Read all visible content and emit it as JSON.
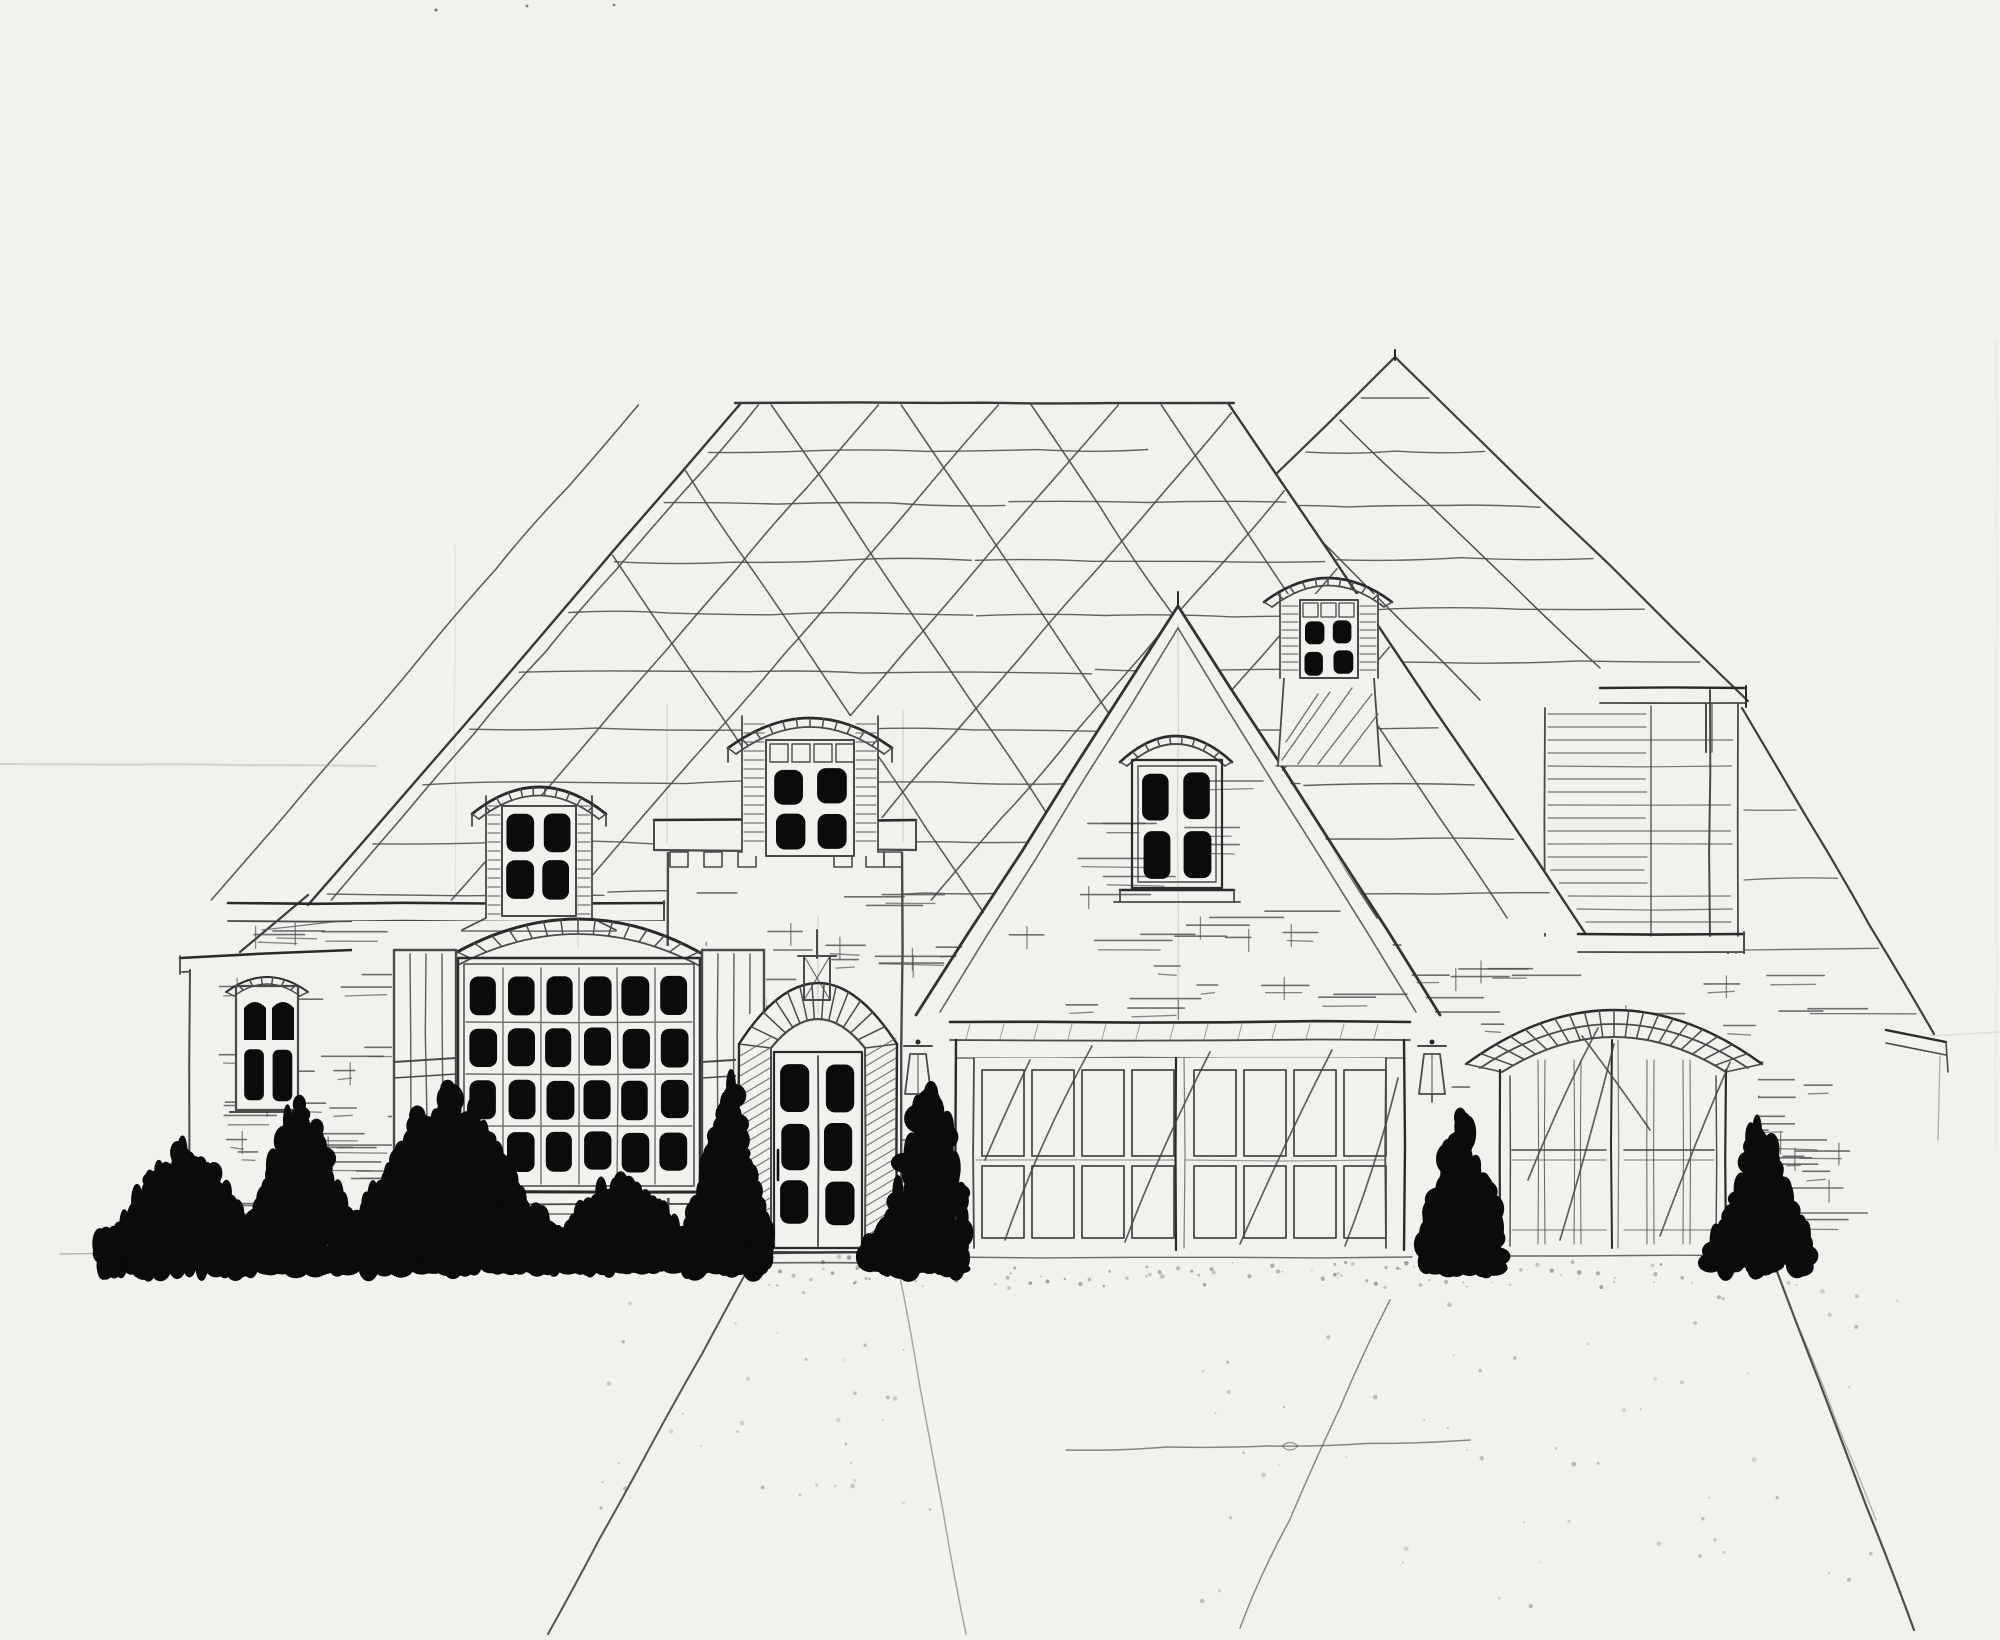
{
  "title": "Hand-drawn front elevation sketch of a brick French country style house",
  "medium": "pencil and ink on paper",
  "palette": {
    "paper": "#f2f1ee",
    "pencil": "#4a4a4a",
    "pencil_dark": "#2a2a2a",
    "pencil_light": "#6a6a6a",
    "ink": "#0b0b0b"
  },
  "inventory": {
    "roof": {
      "type": "steep hipped roof with secondary hip, front gable and clapboard side wing",
      "texture": "wavy shingle course lines with diagonal crosshatch seams",
      "dormer_count": 3
    },
    "windows": [
      {
        "name": "left-wing-window",
        "panes": "2 x 2",
        "style": "arched brick header"
      },
      {
        "name": "left-roof-dormer",
        "panes": "2 x 2",
        "style": "arched-cap wall dormer"
      },
      {
        "name": "grand-arched-window",
        "panes": "6 x 4",
        "style": "brick voussoir arch with board shutters"
      },
      {
        "name": "tower-dormer",
        "panes": "2 x 2 + transom",
        "style": "arched cap over crenellated cornice"
      },
      {
        "name": "gable-window",
        "panes": "2 x 2",
        "style": "arched brick header with sill"
      },
      {
        "name": "roof-stack-dormer",
        "panes": "2 x 2 + transom",
        "style": "arched cap on hatched stack"
      }
    ],
    "doors": [
      {
        "name": "entry-door",
        "panes": "2 x 3",
        "style": "arched brick fan surround with lantern finial"
      },
      {
        "name": "double-garage-door",
        "panels": "4 x 2 per door",
        "count": 2
      },
      {
        "name": "carriage-garage-door",
        "style": "arched brick band, two leaves",
        "count": 1
      }
    ],
    "lighting": [
      {
        "name": "wall-lantern",
        "count": 2
      }
    ],
    "landscape": {
      "bush_clusters": 8,
      "walkway": true,
      "driveway": true
    }
  },
  "bushes": [
    {
      "x0": 100,
      "x1": 258,
      "peak_x": 185,
      "height": 92
    },
    {
      "x0": 238,
      "x1": 352,
      "peak_x": 302,
      "height": 138
    },
    {
      "x0": 348,
      "x1": 560,
      "peak_x": 446,
      "height": 148
    },
    {
      "x0": 556,
      "x1": 696,
      "peak_x": 622,
      "height": 66
    },
    {
      "x0": 688,
      "x1": 768,
      "peak_x": 728,
      "height": 158
    },
    {
      "x0": 868,
      "x1": 962,
      "peak_x": 930,
      "height": 148
    },
    {
      "x0": 1426,
      "x1": 1502,
      "peak_x": 1462,
      "height": 128
    },
    {
      "x0": 1714,
      "x1": 1806,
      "peak_x": 1762,
      "height": 112
    }
  ]
}
